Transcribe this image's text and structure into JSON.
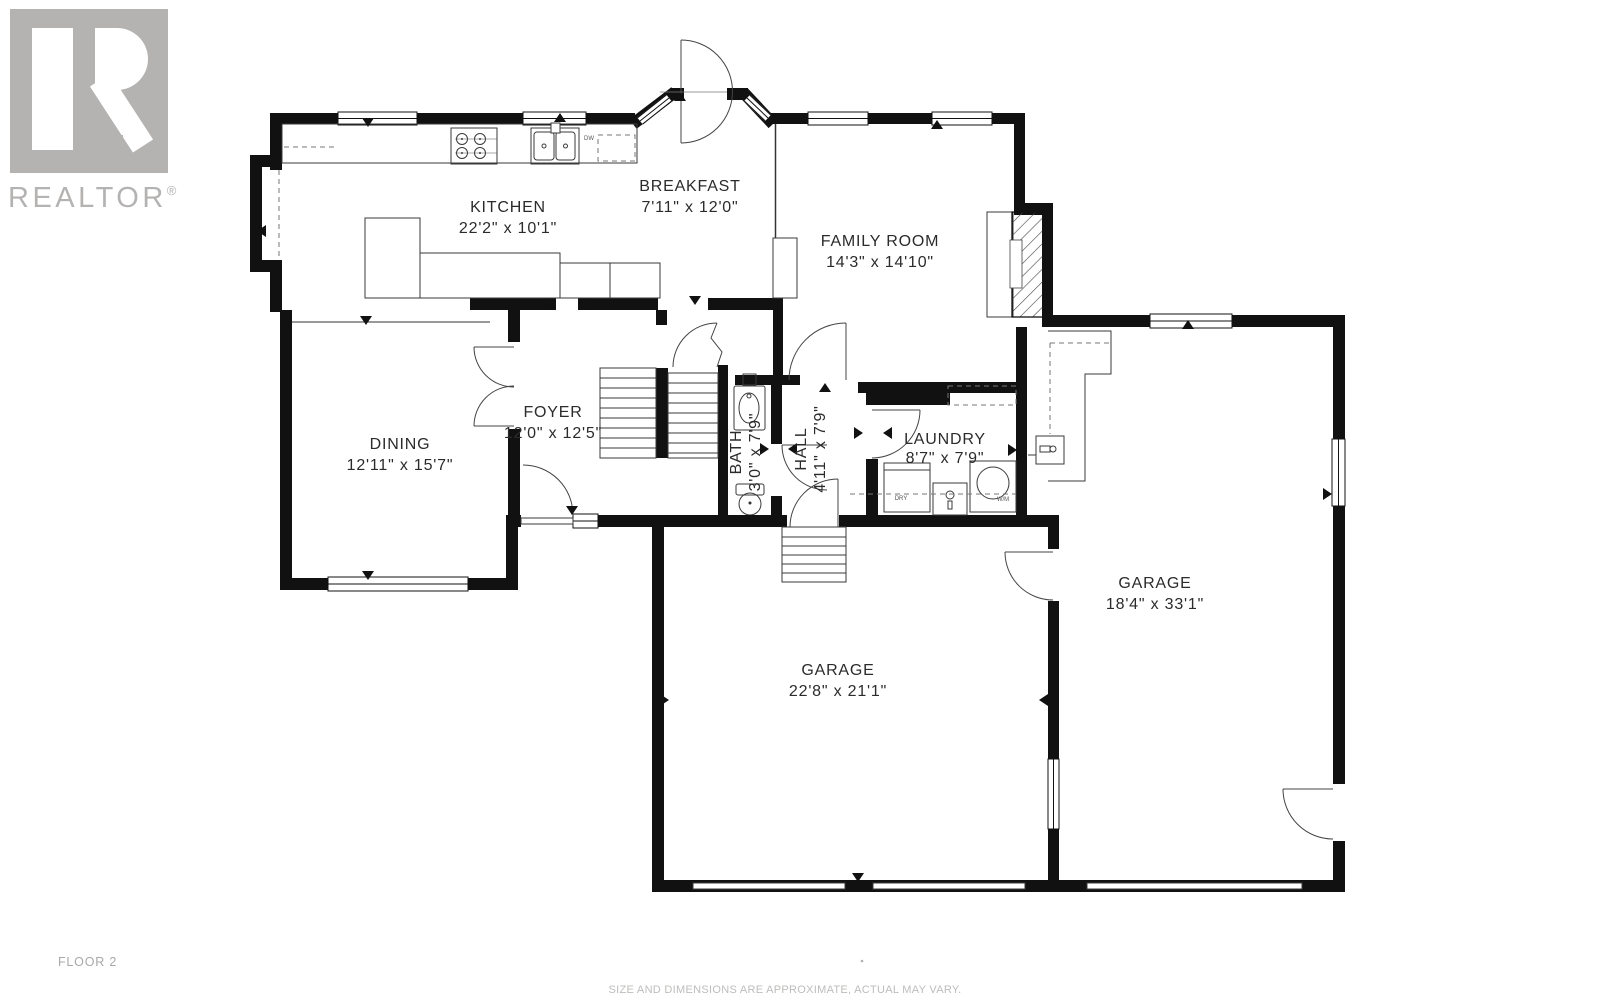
{
  "logo": {
    "brand": "REALTOR",
    "reg": "®"
  },
  "rooms": {
    "kitchen": {
      "name": "KITCHEN",
      "dims": "22'2\" x 10'1\""
    },
    "breakfast": {
      "name": "BREAKFAST",
      "dims": "7'11\" x 12'0\""
    },
    "family_room": {
      "name": "FAMILY ROOM",
      "dims": "14'3\" x 14'10\""
    },
    "dining": {
      "name": "DINING",
      "dims": "12'11\" x 15'7\""
    },
    "foyer": {
      "name": "FOYER",
      "dims": "12'0\" x 12'5\""
    },
    "bath": {
      "name": "BATH",
      "dims": "3'0\" x 7'9\""
    },
    "hall": {
      "name": "HALL",
      "dims": "4'11\" x 7'9\""
    },
    "laundry": {
      "name": "LAUNDRY",
      "dims": "8'7\" x 7'9\""
    },
    "garage_right": {
      "name": "GARAGE",
      "dims": "18'4\" x 33'1\""
    },
    "garage_bottom": {
      "name": "GARAGE",
      "dims": "22'8\" x 21'1\""
    }
  },
  "fixtures": {
    "dishwasher": "DW",
    "dryer": "DRY",
    "washer": "W/M"
  },
  "footer": {
    "floor_label": "FLOOR 2",
    "disclaimer": "SIZE AND DIMENSIONS ARE APPROXIMATE, ACTUAL MAY VARY."
  },
  "colors": {
    "wall": "#111111",
    "logo_gray": "#b5b3b2",
    "footer_gray": "#a8a8a8"
  }
}
